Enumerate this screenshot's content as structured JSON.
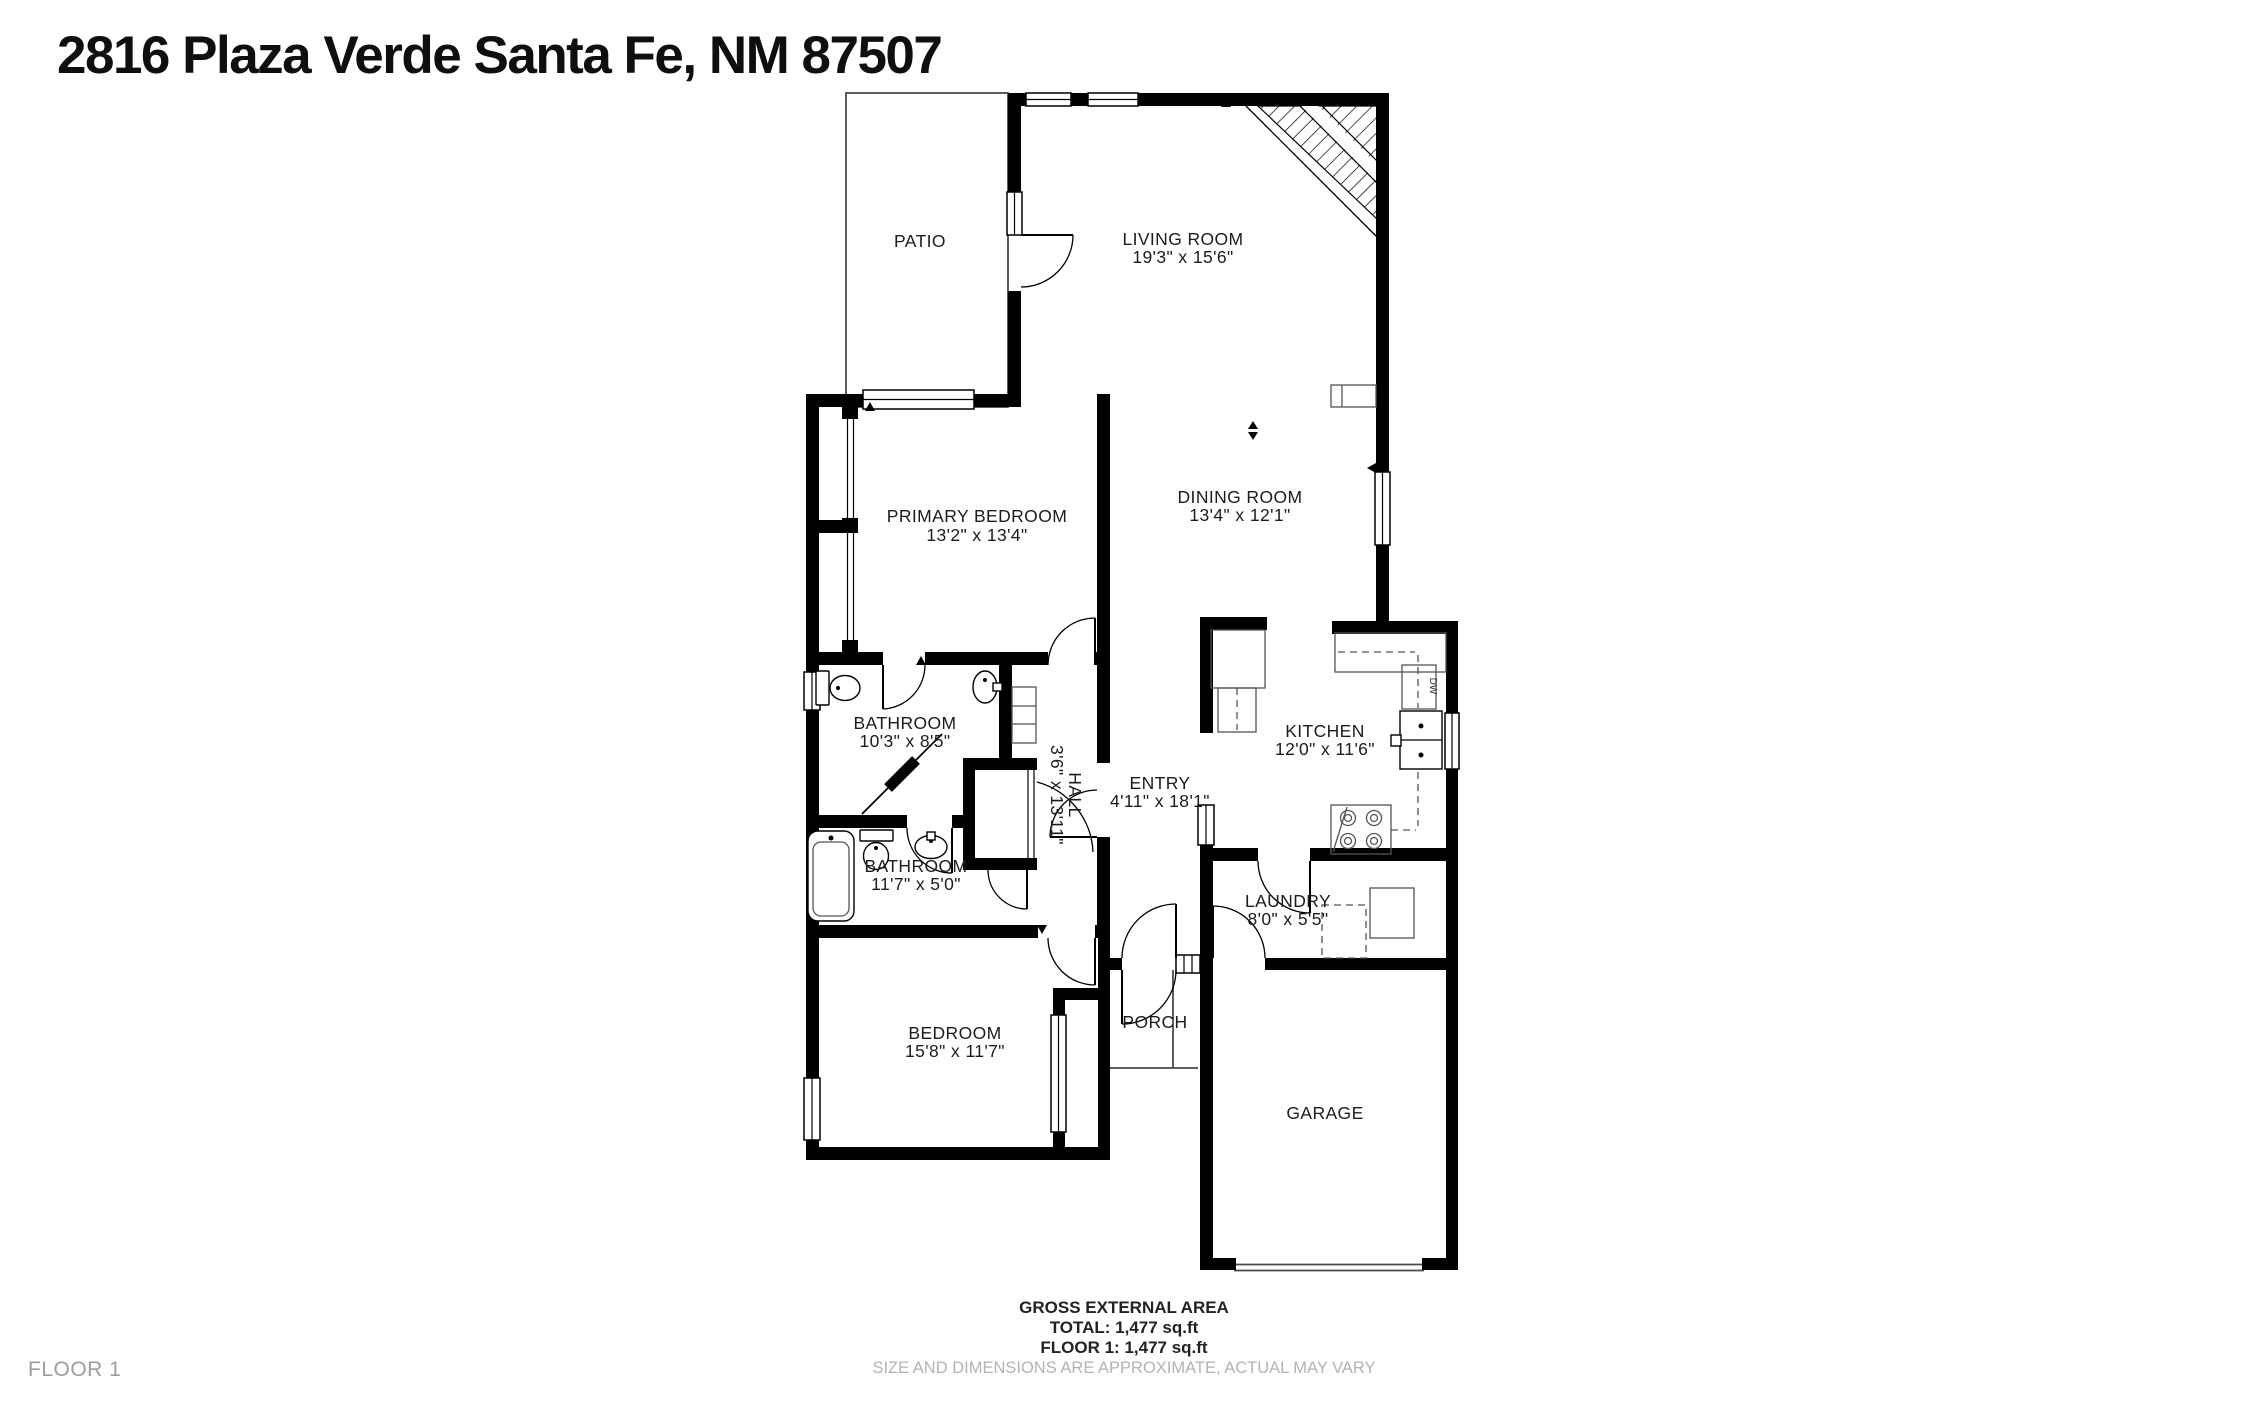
{
  "title": "2816 Plaza Verde Santa Fe, NM 87507",
  "floor_badge": "FLOOR 1",
  "rooms": {
    "patio": {
      "name": "PATIO"
    },
    "living_room": {
      "name": "LIVING ROOM",
      "dims": "19'3\" x 15'6\""
    },
    "dining_room": {
      "name": "DINING ROOM",
      "dims": "13'4\" x 12'1\""
    },
    "primary_bedroom": {
      "name": "PRIMARY BEDROOM",
      "dims": "13'2\" x 13'4\""
    },
    "kitchen": {
      "name": "KITCHEN",
      "dims": "12'0\" x 11'6\""
    },
    "bathroom_1": {
      "name": "BATHROOM",
      "dims": "10'3\" x 8'5\""
    },
    "bathroom_2": {
      "name": "BATHROOM",
      "dims": "11'7\" x 5'0\""
    },
    "hall": {
      "name": "HALL",
      "dims": "3'6\" x 13'11\""
    },
    "entry": {
      "name": "ENTRY",
      "dims": "4'11\" x 18'1\""
    },
    "laundry": {
      "name": "LAUNDRY",
      "dims": "8'0\" x 5'5\""
    },
    "bedroom": {
      "name": "BEDROOM",
      "dims": "15'8\" x 11'7\""
    },
    "porch": {
      "name": "PORCH"
    },
    "garage": {
      "name": "GARAGE"
    }
  },
  "appliances": {
    "dishwasher": "DW"
  },
  "footer": {
    "area_heading": "GROSS EXTERNAL AREA",
    "total": "TOTAL: 1,477 sq.ft",
    "floor1": "FLOOR 1: 1,477 sq.ft",
    "disclaimer": "SIZE AND DIMENSIONS ARE APPROXIMATE, ACTUAL MAY VARY"
  }
}
